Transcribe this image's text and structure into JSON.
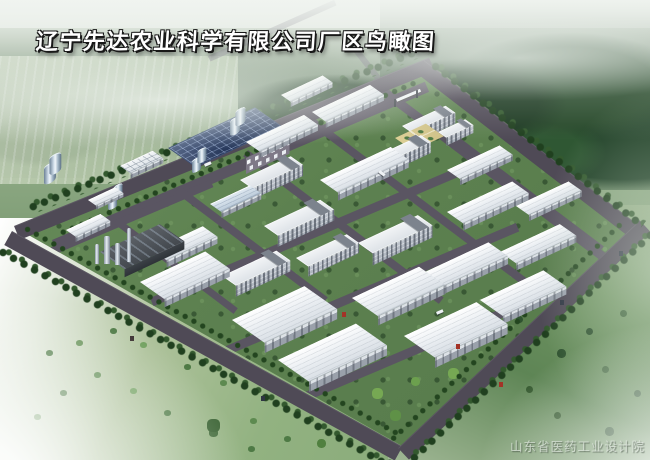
{
  "title": "辽宁先达农业科学有限公司厂区鸟瞰图",
  "watermark": "山东省医药工业设计院",
  "scene": {
    "type": "aerial-birdseye-rendering",
    "subject": "industrial park campus surrounded by forest and fields",
    "elements": [
      "forest belt",
      "misty sky",
      "perimeter roads with tree rows",
      "internal road grid",
      "flat-roof warehouse buildings",
      "multi-story workshop buildings",
      "office complex with tan courtyard",
      "main gate",
      "storage tank farm",
      "solar panel array",
      "boiler plant with stacks",
      "parking lot with white trucks",
      "lawns with scattered trees",
      "open grass fields with bushes"
    ],
    "counts": {
      "warehouse_buildings": 19,
      "multistory_buildings": 8,
      "storage_tanks": 48,
      "boiler_stacks": 4
    },
    "colors": {
      "roof_white": "#eef2f5",
      "wall_gray": "#9aa1ab",
      "road": "#5a5562",
      "perimeter_road": "#4f4a56",
      "lawn_green": "#5d8150",
      "forest_green": "#2a472c",
      "field_green": "#8fb07e",
      "solar_blue": "#2c3e63",
      "tank_steel": "#a9bccd",
      "courtyard_tan": "#d8c98e",
      "mist_white": "#f0f4f0"
    }
  }
}
